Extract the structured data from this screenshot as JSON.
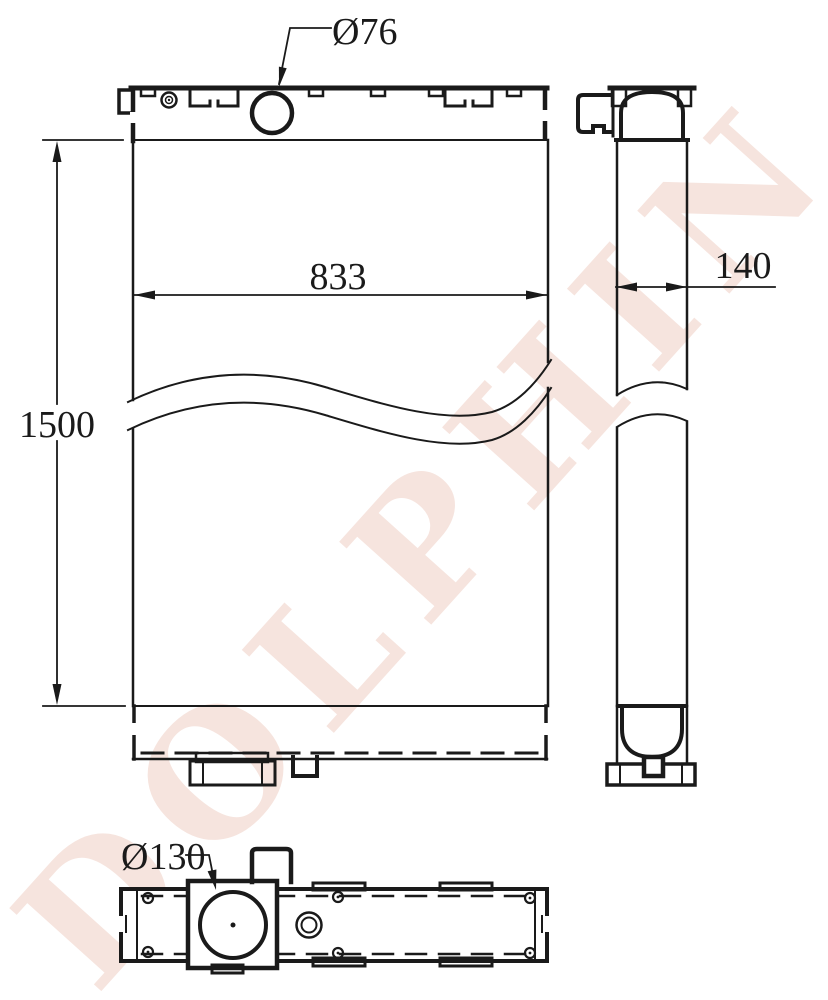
{
  "labels": {
    "filler_diameter": "Ø76",
    "core_width": "833",
    "overall_height": "1500",
    "core_depth": "140",
    "outlet_diameter": "Ø130"
  },
  "watermark": {
    "text": "DOLPHIN",
    "color": "#f6e4de"
  },
  "colors": {
    "line": "#1a1a1a",
    "background": "#ffffff"
  }
}
